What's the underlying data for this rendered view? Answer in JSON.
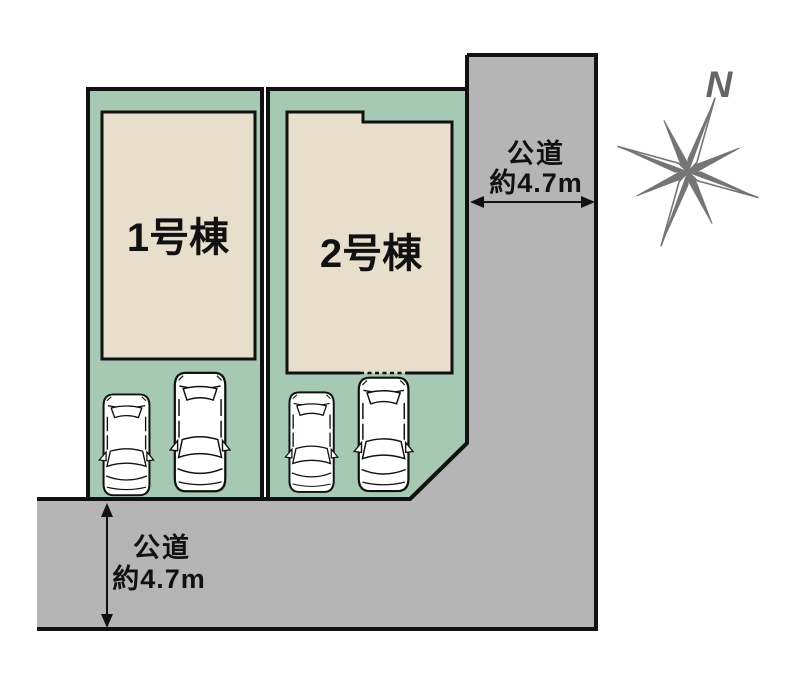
{
  "colors": {
    "lot_green": "#a5c9b3",
    "building_beige": "#e7dfcc",
    "road_gray": "#b5b5b5",
    "outline_black": "#111111",
    "car_white": "#ffffff",
    "compass_gray": "#757575",
    "north_letter_gray": "#666666"
  },
  "lots": [
    {
      "building_label": "1号棟",
      "visible_cars": 2
    },
    {
      "building_label": "2号棟",
      "visible_cars": 2
    }
  ],
  "road_right": {
    "name": "公道",
    "width_label": "約4.7m"
  },
  "road_bottom": {
    "name": "公道",
    "width_label": "約4.7m"
  },
  "compass": {
    "north_label": "N"
  }
}
